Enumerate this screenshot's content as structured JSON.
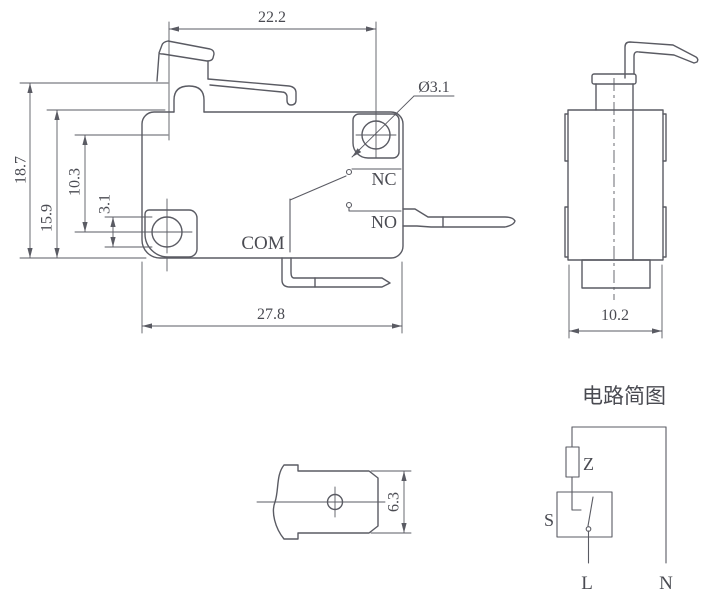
{
  "front_view": {
    "width_top": "22.2",
    "height_total": "18.7",
    "height_body": "15.9",
    "hole_spacing": "10.3",
    "hole_edge": "3.1",
    "hole_diameter": "Ø3.1",
    "width_body": "27.8",
    "terminal_nc": "NC",
    "terminal_no": "NO",
    "terminal_com": "COM"
  },
  "side_view": {
    "width": "10.2"
  },
  "terminal_view": {
    "height": "6.3"
  },
  "circuit_diagram": {
    "title": "电路简图",
    "impedance_label": "Z",
    "switch_label": "S",
    "live_label": "L",
    "neutral_label": "N"
  },
  "colors": {
    "line": "#5a5b63",
    "text": "#4a4b52",
    "background": "#ffffff"
  }
}
